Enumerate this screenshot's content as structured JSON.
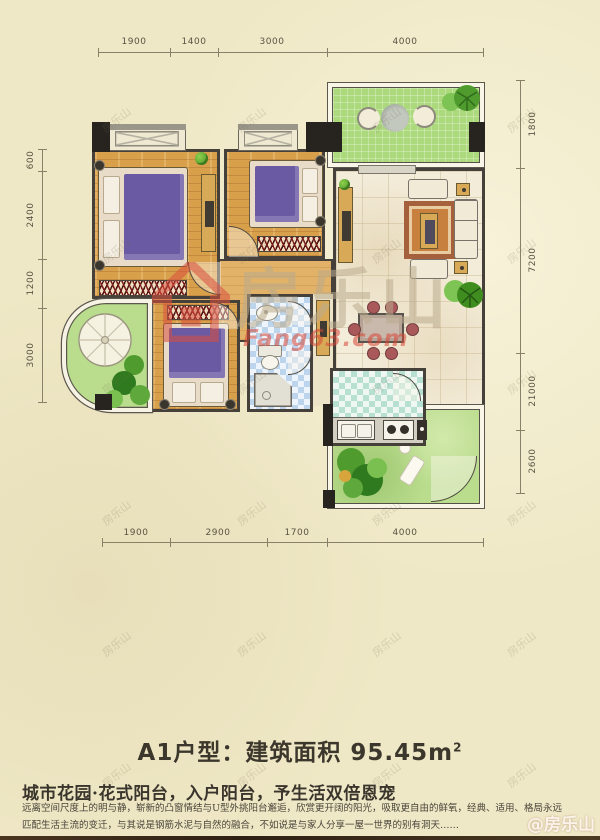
{
  "colors": {
    "bg": "#efe8c6",
    "wall": "#45403a",
    "wood": "#d9a04c",
    "woodLight": "#e2b269",
    "greenBalcony": "#abd97c",
    "greenGarden": "#b9dc8d",
    "livingFloor": "#f3ecd9",
    "bathBlue": "#bcd4ec",
    "kitchenTeal": "#b7e0d2",
    "accentRed": "#d94f3f",
    "bedPurple": "#6a5aa4",
    "ink": "#3c372c"
  },
  "plan": {
    "dims": {
      "top": [
        "1900",
        "1400",
        "3000",
        "4000"
      ],
      "bottom": [
        "1900",
        "2900",
        "1700",
        "4000"
      ],
      "left": [
        "600",
        "2400",
        "1200",
        "3000"
      ],
      "right": [
        "1800",
        "7200",
        "21000",
        "2600"
      ]
    }
  },
  "watermark": {
    "brand": "房乐山",
    "site": "Fang63.com",
    "credit": "@房乐山"
  },
  "caption": {
    "title": "A1户型：建筑面积 95.45m",
    "title_sup": "2",
    "tagline": "城市花园·花式阳台，入户阳台，予生活双倍恩宠",
    "desc1": "远离空间尺度上的明与静，崭新的凸窗情结与U型外挑阳台邂逅，欣赏更开阔的阳光，吸取更自由的鲜氧，经典、适用、格局永远",
    "desc2": "匹配生活主流的变迁，与其说是钢筋水泥与自然的融合，不如说是与家人分享一屋一世界的别有洞天……"
  }
}
